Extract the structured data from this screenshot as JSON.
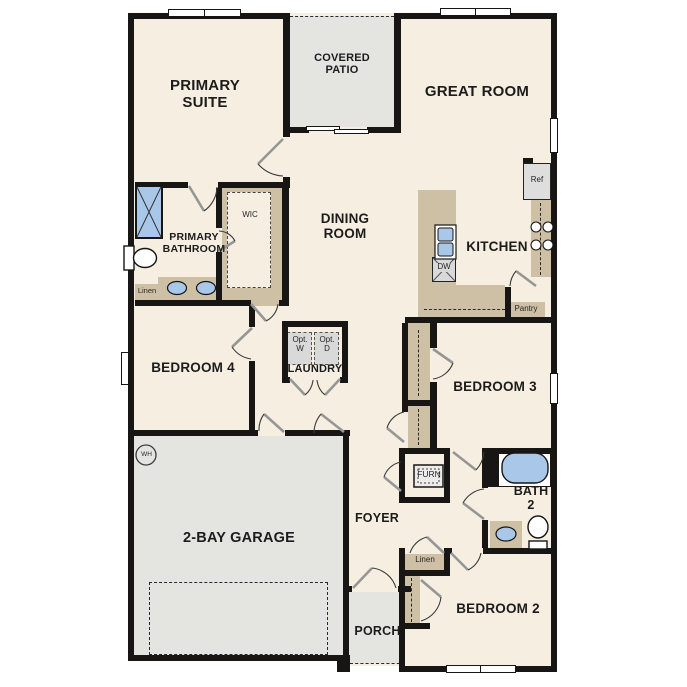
{
  "plan": {
    "rooms": {
      "primary_suite": "PRIMARY SUITE",
      "covered_patio": "COVERED PATIO",
      "great_room": "GREAT ROOM",
      "dining_room": "DINING ROOM",
      "kitchen": "KITCHEN",
      "primary_bathroom": "PRIMARY BATHROOM",
      "wic": "WIC",
      "bedroom4": "BEDROOM 4",
      "laundry": "LAUNDRY",
      "bedroom3": "BEDROOM 3",
      "garage": "2-BAY GARAGE",
      "foyer": "FOYER",
      "bath2": "BATH 2",
      "bedroom2": "BEDROOM 2",
      "porch": "PORCH"
    },
    "features": {
      "linen_primary": "Linen",
      "linen_hall": "Linen",
      "pantry": "Pantry",
      "ref": "Ref",
      "dw": "DW",
      "opt_washer": "Opt. W",
      "opt_dryer": "Opt. D",
      "furnace": "FURN",
      "water_heater": "WH"
    },
    "colors": {
      "floor": "#f6efe1",
      "wall": "#181614",
      "outdoor": "#e4e4e1",
      "casework": "#cdc0a5",
      "fixture_blue": "#a9c8e9"
    }
  }
}
